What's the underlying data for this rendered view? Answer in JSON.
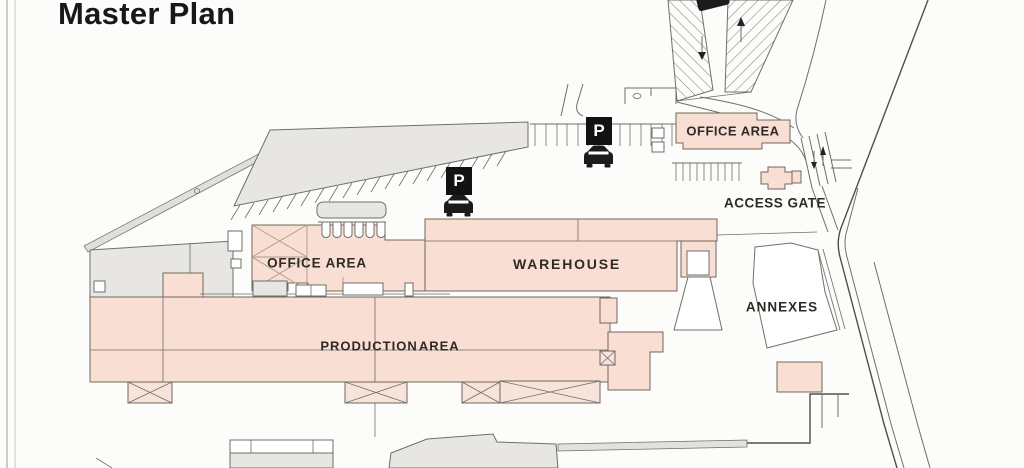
{
  "page": {
    "title": "Master Plan"
  },
  "site_plan": {
    "areas": {
      "office_area_top": {
        "label": "OFFICE AREA"
      },
      "access_gate": {
        "label": "ACCESS GATE"
      },
      "office_area_left": {
        "label": "OFFICE AREA"
      },
      "warehouse": {
        "label": "WAREHOUSE"
      },
      "production_area": {
        "label": "PRODUCTION AREA"
      },
      "annexes": {
        "label": "ANNEXES"
      }
    },
    "markers": {
      "parking_sign_label": "P",
      "parking_signs_count": 2,
      "car_icons_count": 3,
      "direction_arrows_count": 4
    },
    "colors": {
      "background": "#fcfcfa",
      "building_fill": "#f8ded3",
      "building_stroke": "#6f675e",
      "canopy_fill": "#e7e6e2",
      "line": "#6e6e6a",
      "boundary": "#4e4e4a",
      "label_text": "#2f2a26",
      "title_text": "#181818",
      "sign_bg": "#121212",
      "sign_text": "#ffffff"
    }
  }
}
